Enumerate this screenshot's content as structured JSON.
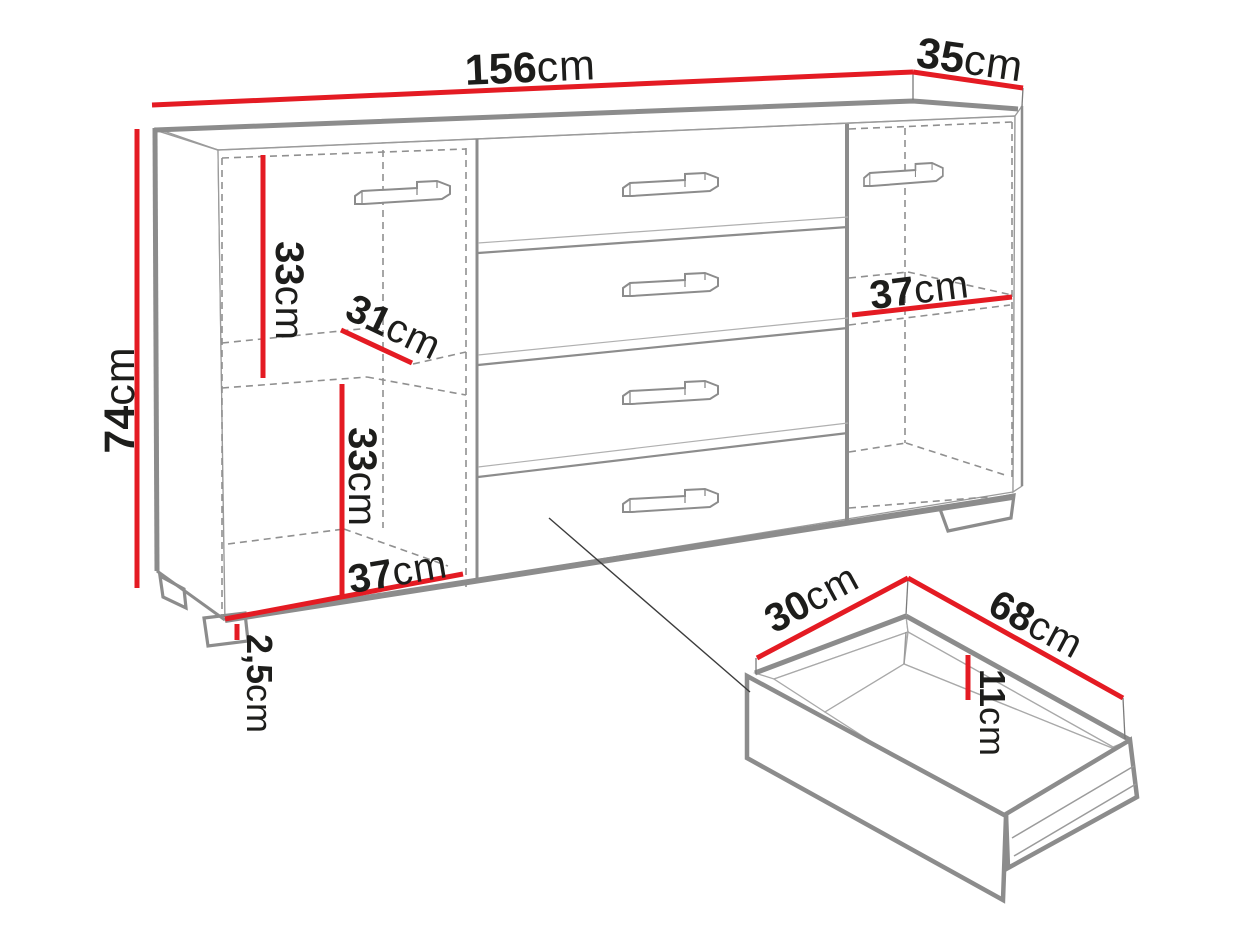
{
  "figure": {
    "type": "furniture-dimension-diagram",
    "subject": "sideboard with two side door compartments and four center drawers, plus a pulled-out drawer detail"
  },
  "colors": {
    "dimension_red": "#e41b23",
    "outline_grey": "#8c8c8c",
    "dashed_grey": "#909090",
    "text_dark": "#1d1d1b",
    "background": "#ffffff"
  },
  "dimensions": {
    "overall_width": {
      "value": "156",
      "unit": "cm"
    },
    "overall_depth": {
      "value": "35",
      "unit": "cm"
    },
    "overall_height": {
      "value": "74",
      "unit": "cm"
    },
    "left_upper_compartment_heightystyle": {
      "value": "33",
      "unit": "cm"
    },
    "left_upper_compartment_height": {
      "value": "33",
      "unit": "cm"
    },
    "left_shelf_depth": {
      "value": "31",
      "unit": "cm"
    },
    "left_lower_compartment_height": {
      "value": "33",
      "unit": "cm"
    },
    "left_compartment_width": {
      "value": "37",
      "unit": "cm"
    },
    "plinth_height": {
      "value": "2,5",
      "unit": "cm"
    },
    "right_compartment_width": {
      "value": "37",
      "unit": "cm"
    },
    "drawer_depth": {
      "value": "30",
      "unit": "cm"
    },
    "drawer_width": {
      "value": "68",
      "unit": "cm"
    },
    "drawer_inner_height": {
      "value": "11",
      "unit": "cm"
    }
  }
}
